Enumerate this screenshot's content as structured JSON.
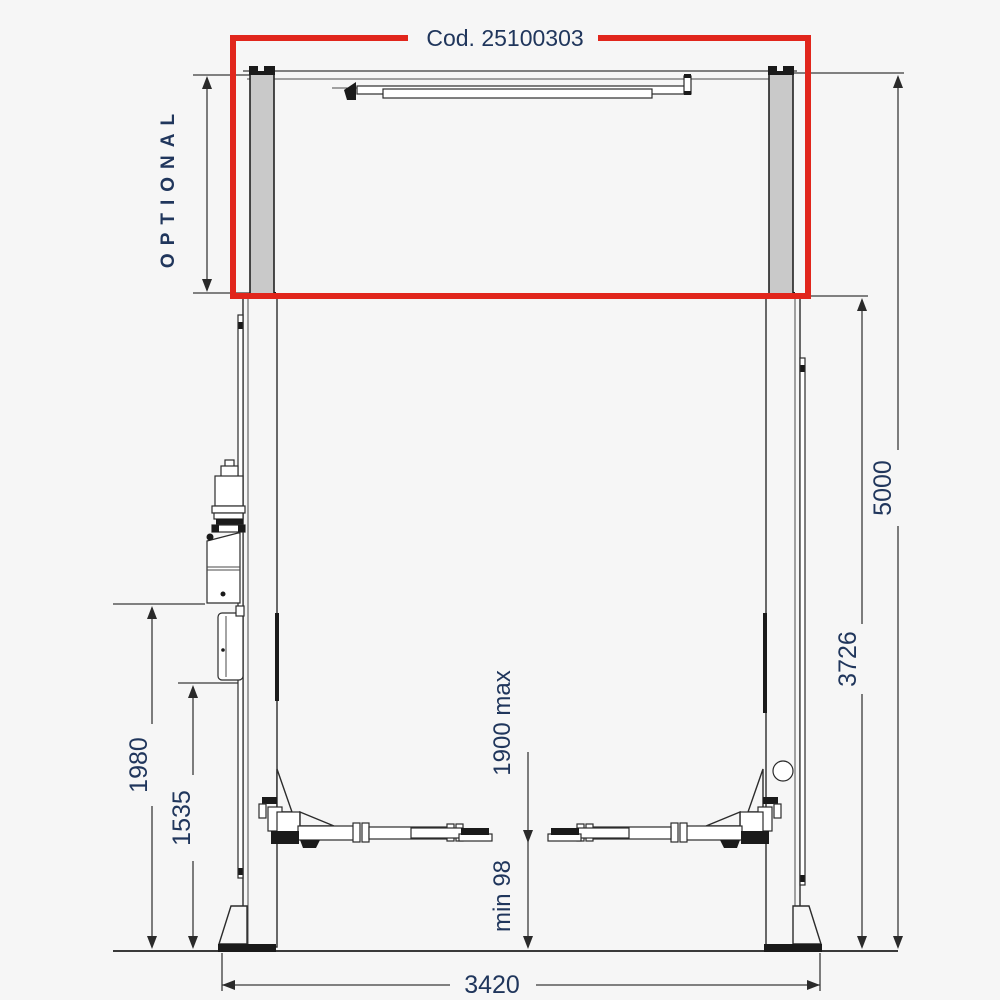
{
  "diagram": {
    "title_code": "Cod. 25100303",
    "optional_label": "OPTIONAL",
    "dims": {
      "overall_height": "5000",
      "column_height": "3726",
      "power_unit_height": "1980",
      "control_box_height": "1535",
      "base_width": "3420",
      "lift_max_height": "1900 max",
      "pad_min_height": "min 98"
    },
    "colors": {
      "highlight_red": "#e1261c",
      "label_navy": "#20365c",
      "line_dark": "#3a3a3a",
      "post_gray": "#c9c9c9",
      "background": "#f6f6f6"
    }
  }
}
